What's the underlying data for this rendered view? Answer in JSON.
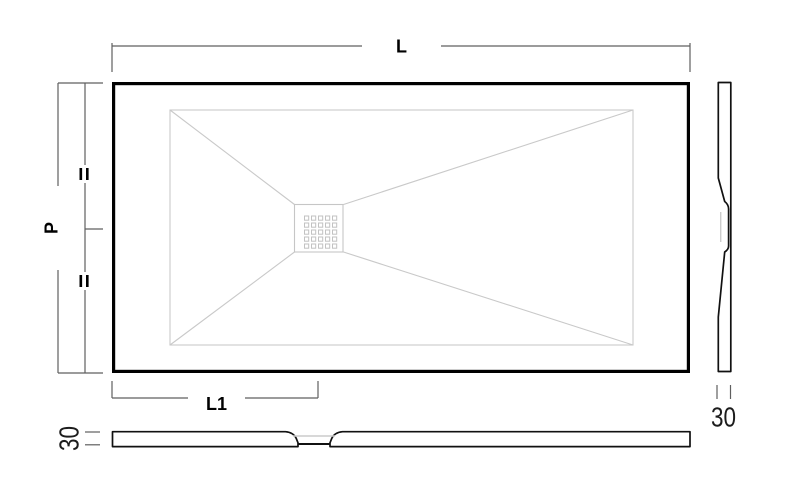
{
  "drawing": {
    "top_view": {
      "length_label": "L",
      "depth_label": "P",
      "drain_offset_label": "L1",
      "equal_marks": [
        "=",
        "="
      ]
    },
    "side_section": {
      "thickness_label": "30"
    },
    "bottom_section": {
      "thickness_label": "30"
    }
  },
  "colors": {
    "outline": "#000000",
    "dimension_line": "#5f5f5f",
    "hidden_line": "#c9c9c9",
    "label_text": "#000000",
    "background": "#ffffff"
  }
}
